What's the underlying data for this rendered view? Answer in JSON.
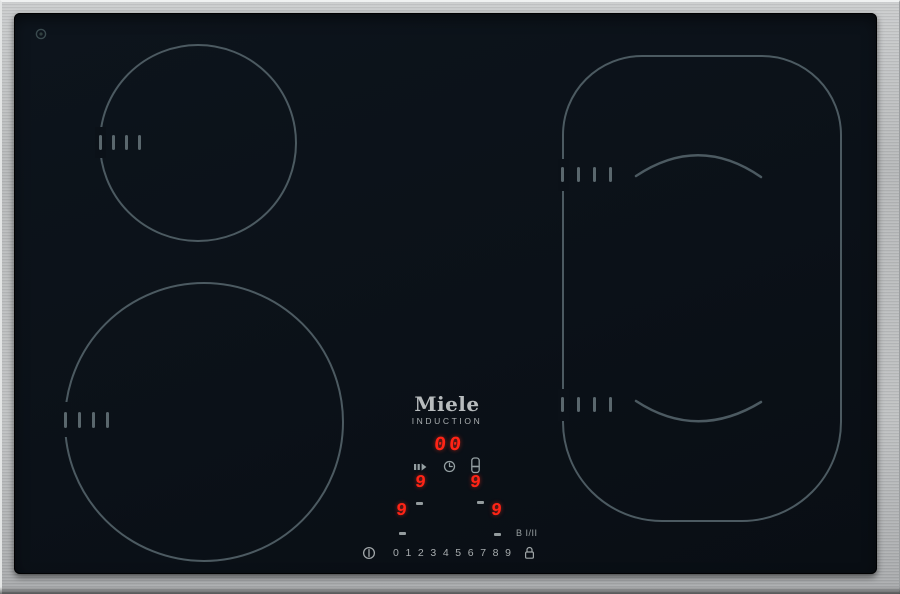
{
  "brand": {
    "logo": "Miele",
    "subtitle": "INDUCTION"
  },
  "panel": {
    "timer_display": "00",
    "zone_display_upper_left": "9",
    "zone_display_upper_right": "9",
    "zone_display_lower_left": "9",
    "zone_display_lower_right": "9",
    "power_slider_digits": "0 1 2 3 4 5 6 7 8 9",
    "booster_label": "B I/II"
  },
  "icons": {
    "power": "power-icon",
    "lock": "lock-icon",
    "stop_go": "stop-and-go-icon",
    "timer": "clock-icon",
    "minute_minder": "minute-minder-icon",
    "emblem": "glass-emblem-icon"
  },
  "colors": {
    "led_red": "#ff2416",
    "zone_outline": "#4c5a61",
    "control_gray": "#a8adaf",
    "glass_black": "#0b1118",
    "frame_steel": "#b9bbbc"
  },
  "zones": {
    "rear_left": "cooking-zone-rear-left",
    "front_left": "cooking-zone-front-left",
    "right_flex": "cooking-zone-right-flex"
  }
}
